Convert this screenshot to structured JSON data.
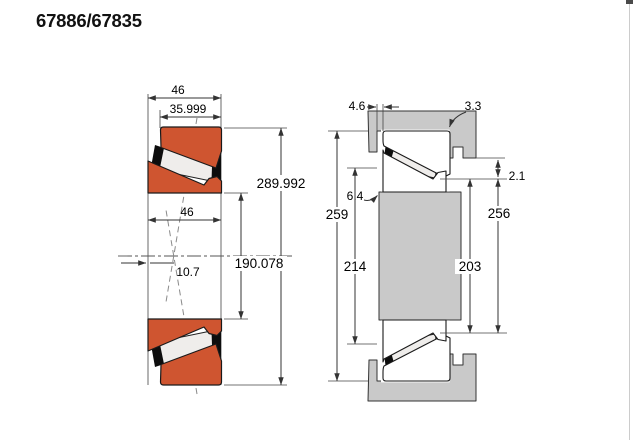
{
  "page": {
    "title": "67886/67835"
  },
  "colors": {
    "ring_orange": "#cf5530",
    "steel_gray": "#c9c9c9",
    "line": "#333333"
  },
  "section_figure": {
    "dims": {
      "overall_width": "46",
      "cup_width": "35.999",
      "outer_diameter": "289.992",
      "inner_width": "46",
      "bore_diameter": "190.078",
      "load_center_offset": "10.7"
    }
  },
  "mounting_figure": {
    "dims": {
      "backface_clearance": "4.6",
      "housing_fillet": "3.3",
      "shaft_fillet": "6.4",
      "cup_standout": "2.1",
      "cup_backing_diameter": "259",
      "shaft_shoulder_diameter": "214",
      "cone_backing_diameter": "203",
      "housing_shoulder_diameter": "256"
    }
  }
}
